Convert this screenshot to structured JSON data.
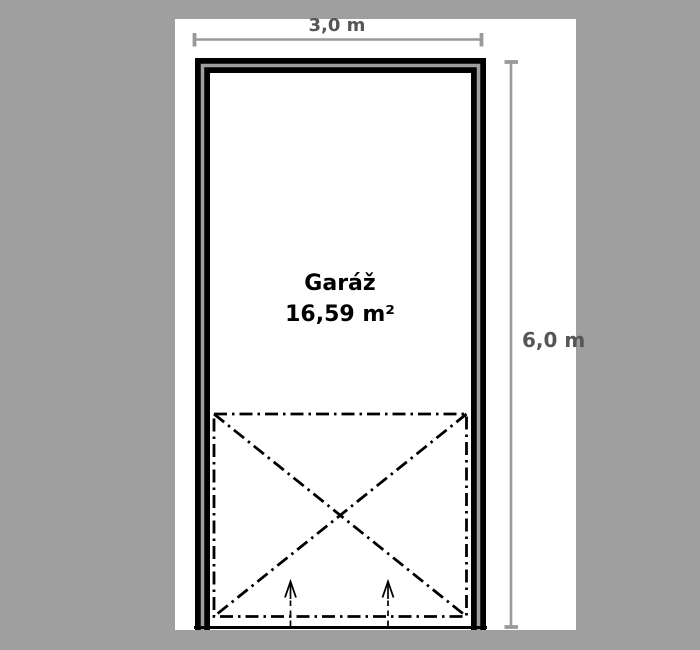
{
  "plan": {
    "room": {
      "name": "Garáž",
      "area": "16,59 m²"
    },
    "dimensions": {
      "width": "3,0 m",
      "height": "6,0 m"
    }
  },
  "colors": {
    "background": "#9f9f9f",
    "panel": "#ffffff",
    "wall_line": "#000000",
    "wall_core": "#9f9f9f",
    "dimension_line": "#9a9a9a",
    "dimension_text": "#565656",
    "room_text": "#000000",
    "door_swing_line": "#000000"
  }
}
